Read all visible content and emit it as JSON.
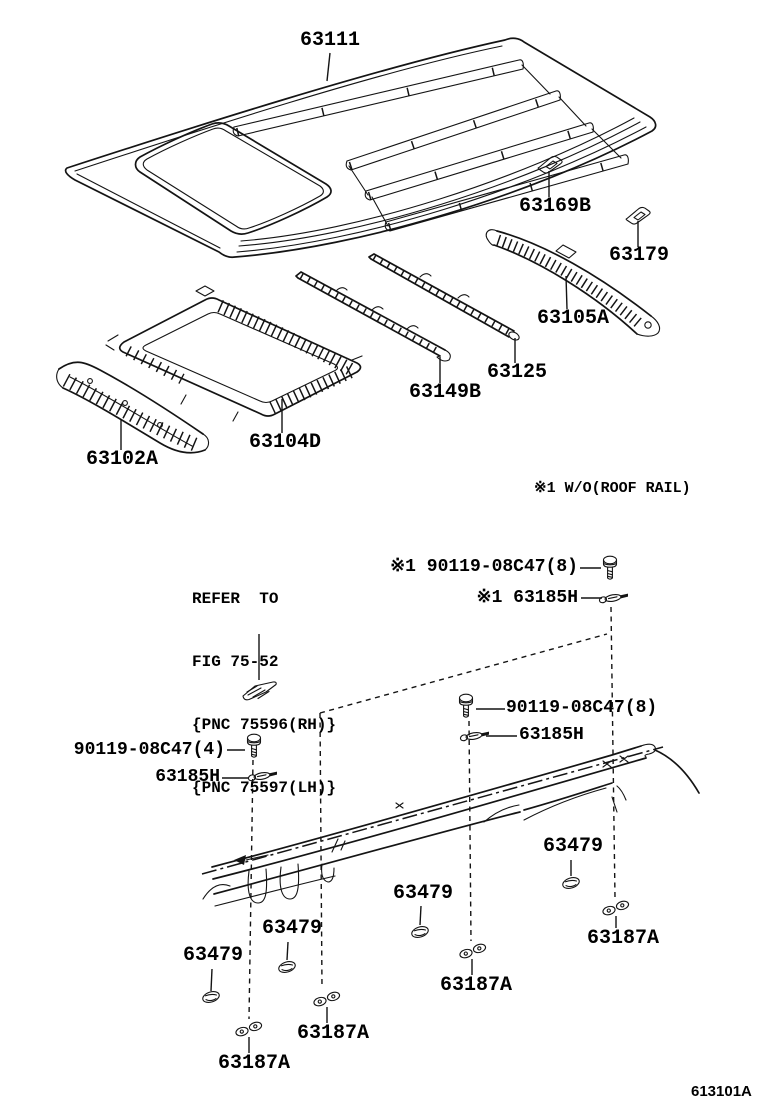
{
  "figure": {
    "code": "613101A",
    "note_wo_roof_rail": "※1 W/O(ROOF RAIL)",
    "refer_note": {
      "line1": "REFER  TO",
      "line2": "FIG 75-52",
      "line3": "{PNC 75596(RH)}",
      "line4": "{PNC 75597(LH)}"
    }
  },
  "parts": {
    "roof_panel": "63111",
    "roof_pad_no2": "63169B",
    "roof_pad_no3": "63179",
    "roof_rear_reinforcement": "63105A",
    "roof_center_brace": "63125",
    "roof_front_brace": "63149B",
    "sliding_roof_housing": "63104D",
    "roof_front_reinforcement": "63102A",
    "drip_channel_grommet": "63479",
    "drip_channel_retainer": "63187A"
  },
  "fasteners": {
    "bolt_top": "※1 90119-08C47(8)",
    "clip_top": "※1 63185H",
    "bolt_mid": "90119-08C47(8)",
    "clip_mid": "63185H",
    "bolt_left": "90119-08C47(4)",
    "clip_left": "63185H"
  },
  "icons": {
    "bolt": "bolt-icon",
    "clip": "clip-icon",
    "grommet": "grommet-icon",
    "retainer": "retainer-icon",
    "pad": "pad-icon",
    "bracket": "bracket-icon"
  },
  "colors": {
    "line": "#141414",
    "background": "#ffffff",
    "text": "#000000"
  }
}
